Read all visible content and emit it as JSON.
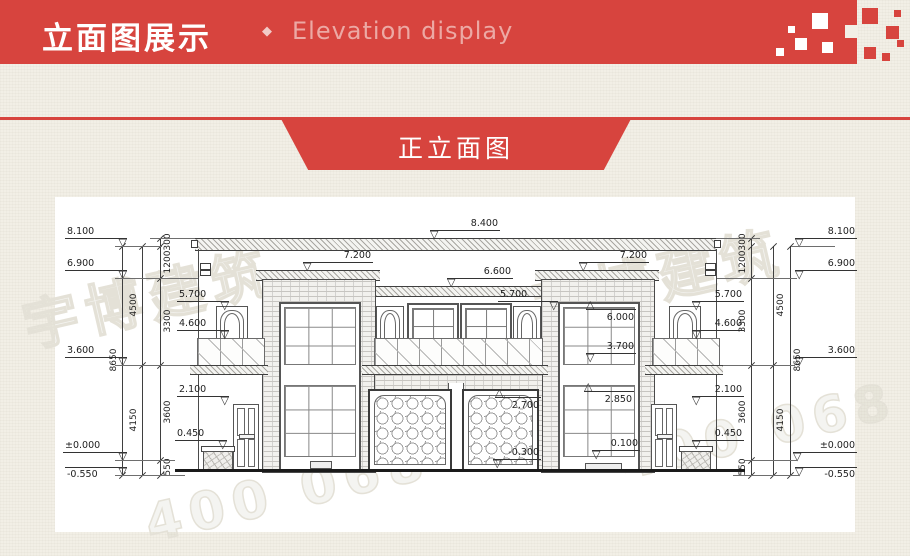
{
  "header": {
    "title": "立面图展示",
    "separator": "◆",
    "subtitle": "Elevation display",
    "banner_color": "#D7443E",
    "subtitle_color": "#ECA9A4"
  },
  "ribbon": {
    "label": "正立面图"
  },
  "watermark": {
    "phone": "400 068 0100",
    "logo": "宇博建筑"
  },
  "drawing": {
    "markers": [
      {
        "group": "far-left",
        "label": "8.100",
        "x": 10,
        "y": 49,
        "w": 62,
        "tri": "r",
        "style": "std"
      },
      {
        "group": "far-left",
        "label": "6.900",
        "x": 10,
        "y": 81,
        "w": 62,
        "tri": "r",
        "style": "std"
      },
      {
        "group": "far-left",
        "label": "3.600",
        "x": 10,
        "y": 168,
        "w": 62,
        "tri": "r",
        "style": "std"
      },
      {
        "group": "far-left",
        "label": "±0.000",
        "x": 8,
        "y": 263,
        "w": 64,
        "tri": "r",
        "style": "std"
      },
      {
        "group": "far-left",
        "label": "-0.550",
        "x": 10,
        "y": 278,
        "w": 62,
        "tri": "r",
        "style": "flipt"
      },
      {
        "group": "inner-left",
        "label": "5.700",
        "x": 122,
        "y": 112,
        "w": 52,
        "tri": "r",
        "style": "std"
      },
      {
        "group": "inner-left",
        "label": "4.600",
        "x": 122,
        "y": 141,
        "w": 52,
        "tri": "r",
        "style": "std"
      },
      {
        "group": "inner-left",
        "label": "2.100",
        "x": 122,
        "y": 207,
        "w": 52,
        "tri": "r",
        "style": "std"
      },
      {
        "group": "inner-left",
        "label": "0.450",
        "x": 120,
        "y": 251,
        "w": 52,
        "tri": "r",
        "style": "std"
      },
      {
        "group": "top",
        "label": "8.400",
        "x": 375,
        "y": 41,
        "w": 70,
        "tri": "l",
        "style": "std"
      },
      {
        "group": "top",
        "label": "7.200",
        "x": 248,
        "y": 73,
        "w": 70,
        "tri": "l",
        "style": "std"
      },
      {
        "group": "top",
        "label": "7.200",
        "x": 524,
        "y": 73,
        "w": 70,
        "tri": "l",
        "style": "std"
      },
      {
        "group": "top",
        "label": "6.600",
        "x": 392,
        "y": 89,
        "w": 66,
        "tri": "l",
        "style": "std"
      },
      {
        "group": "mid",
        "label": "5.700",
        "x": 443,
        "y": 112,
        "w": 60,
        "tri": "r",
        "style": "std"
      },
      {
        "group": "stair-window",
        "label": "6.000",
        "x": 531,
        "y": 104,
        "w": 50,
        "tri": "l",
        "style": "flip"
      },
      {
        "group": "stair-window",
        "label": "3.700",
        "x": 531,
        "y": 164,
        "w": 50,
        "tri": "l",
        "style": "std"
      },
      {
        "group": "stair-window",
        "label": "2.850",
        "x": 529,
        "y": 186,
        "w": 50,
        "tri": "l",
        "style": "flip"
      },
      {
        "group": "garage",
        "label": "2.700",
        "x": 440,
        "y": 192,
        "w": 46,
        "tri": "l",
        "style": "flip"
      },
      {
        "group": "garage",
        "label": "-0.300",
        "x": 438,
        "y": 270,
        "w": 48,
        "tri": "l",
        "style": "std"
      },
      {
        "group": "entry",
        "label": "0.100",
        "x": 537,
        "y": 261,
        "w": 48,
        "tri": "l",
        "style": "std"
      },
      {
        "group": "far-right",
        "label": "8.100",
        "x": 740,
        "y": 49,
        "w": 62,
        "tri": "l",
        "style": "std"
      },
      {
        "group": "far-right",
        "label": "6.900",
        "x": 740,
        "y": 81,
        "w": 62,
        "tri": "l",
        "style": "std"
      },
      {
        "group": "far-right",
        "label": "3.600",
        "x": 740,
        "y": 168,
        "w": 62,
        "tri": "l",
        "style": "std"
      },
      {
        "group": "far-right",
        "label": "±0.000",
        "x": 738,
        "y": 263,
        "w": 64,
        "tri": "l",
        "style": "std"
      },
      {
        "group": "far-right",
        "label": "-0.550",
        "x": 740,
        "y": 278,
        "w": 62,
        "tri": "l",
        "style": "flipt"
      },
      {
        "group": "inner-right",
        "label": "5.700",
        "x": 637,
        "y": 112,
        "w": 52,
        "tri": "l",
        "style": "std"
      },
      {
        "group": "inner-right",
        "label": "4.600",
        "x": 637,
        "y": 141,
        "w": 52,
        "tri": "l",
        "style": "std"
      },
      {
        "group": "inner-right",
        "label": "2.100",
        "x": 637,
        "y": 207,
        "w": 52,
        "tri": "l",
        "style": "std"
      },
      {
        "group": "inner-right",
        "label": "0.450",
        "x": 637,
        "y": 251,
        "w": 52,
        "tri": "l",
        "style": "std"
      }
    ],
    "chains": {
      "left": [
        {
          "x": 67,
          "y1": 49,
          "y2": 278,
          "ticks": [
            49,
            278
          ],
          "labels": [
            {
              "t": "8650",
              "y": 163
            }
          ],
          "side": "l"
        },
        {
          "x": 87,
          "y1": 49,
          "y2": 278,
          "ticks": [
            49,
            168,
            278
          ],
          "labels": [
            {
              "t": "4500",
              "y": 108
            },
            {
              "t": "4150",
              "y": 223
            }
          ],
          "side": "l"
        },
        {
          "x": 105,
          "y1": 41,
          "y2": 278,
          "ticks": [
            41,
            49,
            81,
            168,
            263,
            278
          ],
          "labels": [
            {
              "t": "300",
              "y": 45
            },
            {
              "t": "1200",
              "y": 65
            },
            {
              "t": "3300",
              "y": 124
            },
            {
              "t": "3600",
              "y": 215
            },
            {
              "t": "550",
              "y": 270
            }
          ],
          "side": "r"
        }
      ],
      "right": [
        {
          "x": 735,
          "y1": 49,
          "y2": 278,
          "ticks": [
            49,
            278
          ],
          "labels": [
            {
              "t": "8650",
              "y": 163
            }
          ],
          "side": "r"
        },
        {
          "x": 718,
          "y1": 49,
          "y2": 278,
          "ticks": [
            49,
            168,
            278
          ],
          "labels": [
            {
              "t": "4500",
              "y": 108
            },
            {
              "t": "4150",
              "y": 223
            }
          ],
          "side": "r"
        },
        {
          "x": 696,
          "y1": 41,
          "y2": 278,
          "ticks": [
            41,
            49,
            81,
            168,
            263,
            278
          ],
          "labels": [
            {
              "t": "300",
              "y": 45
            },
            {
              "t": "1200",
              "y": 65
            },
            {
              "t": "3300",
              "y": 124
            },
            {
              "t": "3600",
              "y": 215
            },
            {
              "t": "550",
              "y": 270
            }
          ],
          "side": "l"
        }
      ]
    },
    "ext_lines": [
      {
        "x": 60,
        "y": 49,
        "w": 47
      },
      {
        "x": 95,
        "y": 41,
        "w": 45
      },
      {
        "x": 60,
        "y": 81,
        "w": 83
      },
      {
        "x": 60,
        "y": 168,
        "w": 75
      },
      {
        "x": 60,
        "y": 263,
        "w": 60
      },
      {
        "x": 60,
        "y": 278,
        "w": 70
      },
      {
        "x": 736,
        "y": 49,
        "w": 44
      },
      {
        "x": 661,
        "y": 41,
        "w": 44
      },
      {
        "x": 662,
        "y": 81,
        "w": 80
      },
      {
        "x": 668,
        "y": 168,
        "w": 72
      },
      {
        "x": 690,
        "y": 263,
        "w": 52
      },
      {
        "x": 678,
        "y": 278,
        "w": 66
      }
    ]
  }
}
